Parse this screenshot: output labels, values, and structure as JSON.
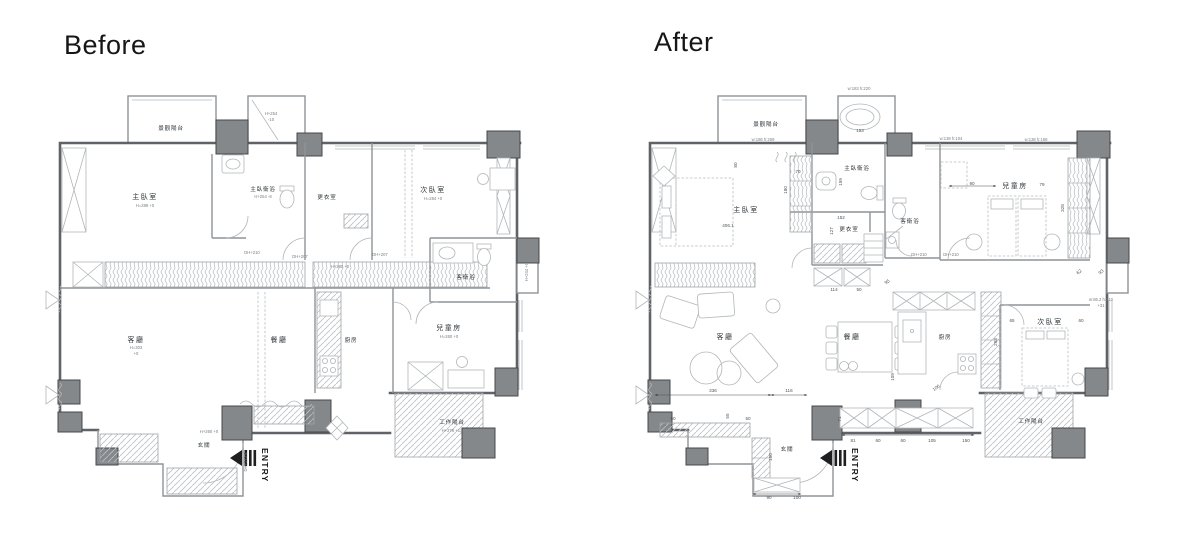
{
  "titles": {
    "before": "Before",
    "after": "After"
  },
  "entry": {
    "label": "ENTRY"
  },
  "colors": {
    "background": "#ffffff",
    "column_fill": "#85888b",
    "column_outline": "#45484b",
    "wall_dark": "#5f6367",
    "wall_light": "#b2b6b9",
    "label_text": "#33383b",
    "title_text": "#161616"
  },
  "before": {
    "labels": {
      "view_balcony": "景觀陽台",
      "master_bedroom": "主臥室",
      "master_bath": "主臥衛浴",
      "dressing": "更衣室",
      "bedroom2": "次臥室",
      "guest_bath": "客衛浴",
      "living": "客廳",
      "dining": "餐廳",
      "kitchen": "廚房",
      "kids": "兒童房",
      "foyer": "玄關",
      "work_balcony": "工作陽台"
    },
    "notes": {
      "master_bedroom": "H=289 +0",
      "bath_top_h": "H+254",
      "bath_top_v": "-10",
      "master_bath": "H+254 -8",
      "bedroom2": "H=284 +0",
      "living_h": "H=303",
      "living_v": "+0",
      "kitchen": "H+280 +0",
      "kids": "H=260 +0",
      "foyer": "H+260 +0",
      "work_balcony": "H+278 +13",
      "right_balcony": "H+244 +0",
      "door1": "DH+207",
      "door2": "DH+207",
      "door3": "DH+210",
      "door4": "DH+213.5"
    }
  },
  "after": {
    "labels": {
      "view_balcony": "景觀陽台",
      "master_bedroom": "主臥室",
      "master_bath": "主臥衛浴",
      "dressing": "更衣室",
      "bedroom2": "次臥室",
      "guest_bath": "客衛浴",
      "living": "客廳",
      "dining": "餐廳",
      "kitchen": "廚房",
      "kids": "兒童房",
      "foyer": "玄關",
      "work_balcony": "工作陽台"
    },
    "notes": {
      "balcony_win": "w:186 h:269",
      "bath_win": "w:183 h:220",
      "kids_win1": "w:138 h:104",
      "kids_win2": "w:138 h:168",
      "side_win": "w:86.2 h:210",
      "side_win2": "+31",
      "door1": "DH+210",
      "door2": "DH+210"
    },
    "dims": {
      "d153": "153",
      "d80": "80",
      "d70": "70",
      "d180": "180",
      "d159": "159",
      "d152": "152",
      "d127": "127",
      "d406": "406.1",
      "d90": "90",
      "d79": "79",
      "d328": "328",
      "d95": "95",
      "d114": "114",
      "d50a": "50",
      "d336": "336",
      "d116": "116",
      "d55": "55",
      "d50b": "50",
      "d50c": "50",
      "d109": "109",
      "d65": "65",
      "d60a": "60",
      "d293": "293",
      "d106": "106",
      "d71": "71",
      "d81": "81",
      "d60b": "60",
      "d60c": "60",
      "d105": "105",
      "d150a": "150",
      "d150b": "150",
      "d90c": "90",
      "d100": "100",
      "d62": "62",
      "d93": "93"
    }
  }
}
